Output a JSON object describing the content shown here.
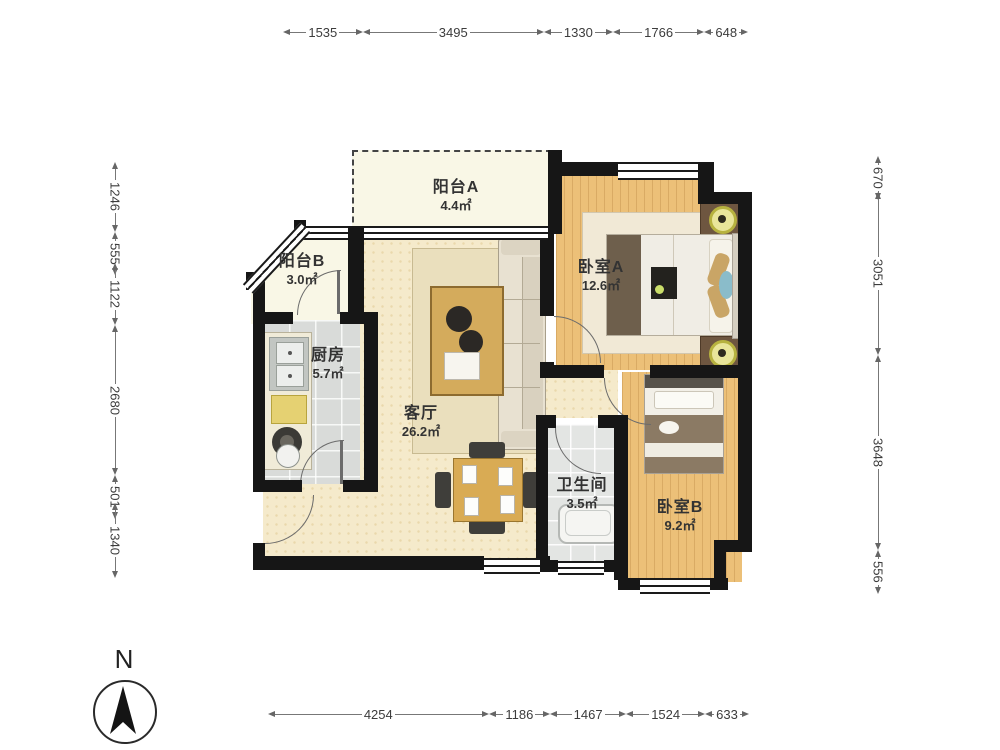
{
  "compass": {
    "label": "N"
  },
  "rooms": [
    {
      "name": "阳台A",
      "area": "4.4㎡"
    },
    {
      "name": "阳台B",
      "area": "3.0㎡"
    },
    {
      "name": "厨房",
      "area": "5.7㎡"
    },
    {
      "name": "客厅",
      "area": "26.2㎡"
    },
    {
      "name": "卧室A",
      "area": "12.6㎡"
    },
    {
      "name": "卫生间",
      "area": "3.5㎡"
    },
    {
      "name": "卧室B",
      "area": "9.2㎡"
    }
  ],
  "dimensions": {
    "top": [
      {
        "value": "1535"
      },
      {
        "value": "3495"
      },
      {
        "value": "1330"
      },
      {
        "value": "1766"
      },
      {
        "value": "648"
      }
    ],
    "bottom": [
      {
        "value": "4254"
      },
      {
        "value": "1186"
      },
      {
        "value": "1467"
      },
      {
        "value": "1524"
      },
      {
        "value": "633"
      }
    ],
    "left": [
      {
        "value": "1246"
      },
      {
        "value": "555"
      },
      {
        "value": "1122"
      },
      {
        "value": "2680"
      },
      {
        "value": "501"
      },
      {
        "value": "1340"
      }
    ],
    "right": [
      {
        "value": "670"
      },
      {
        "value": "3051"
      },
      {
        "value": "3648"
      },
      {
        "value": "556"
      }
    ]
  },
  "colors": {
    "wall": "#161616",
    "wood_floor": "#ecc078",
    "living_floor": "#f5eacb",
    "tile_floor": "#d9dbd9",
    "balcony_floor": "#f9f7e6",
    "dimension_line": "#777777"
  }
}
